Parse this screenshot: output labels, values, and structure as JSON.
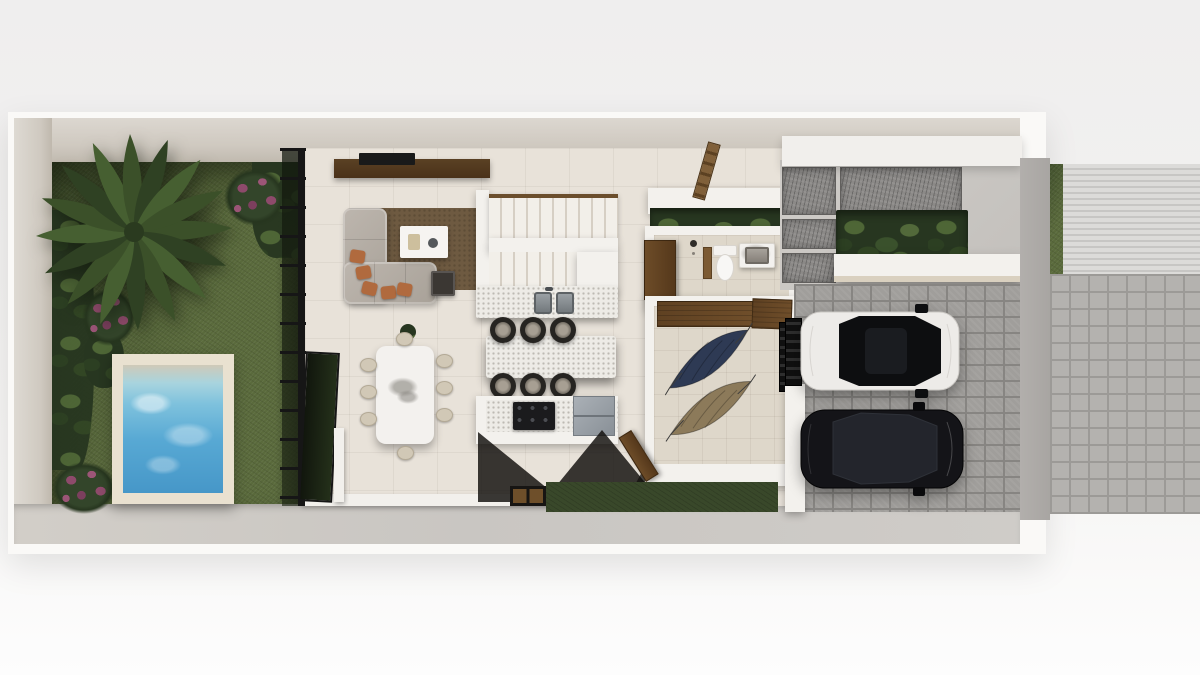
{
  "meta": {
    "title": "Townhouse ground-floor plan — top-down 3D render",
    "view": "top-down",
    "style": "architectural visualization, no text labels"
  },
  "palette": {
    "background_top": "#efeeee",
    "background_bottom": "#fdfdfd",
    "plot_rim": "#faf9f7",
    "wall_light": "#dcd7d0",
    "wall_dark": "#bfb8ad",
    "lawn": "#5a6a3c",
    "lawn_dark": "#42512d",
    "lawn_front": "#39482a",
    "flower": "#8e4a6b",
    "leaf": "#3a512c",
    "pool_frame": "#e9e1d0",
    "pool_water": "#4f9fd0",
    "floor": "#e8e2d9",
    "terrace": "#d6d1c8",
    "frame_black": "#161616",
    "wood": "#6d4c28",
    "wood_dark": "#55381b",
    "rug": "#6e5a41",
    "sofa": "#b3aca3",
    "cushion": "#b06a3e",
    "white_furniture": "#f3f1ed",
    "counter": "#edebe6",
    "stool": "#262421",
    "steel": "#99a0a7",
    "stone_slab": "#8b8987",
    "concrete": "#c9c6c2",
    "paver": "#a09e9b",
    "paver_gap": "#878582",
    "side_wall": "#a8a5a2",
    "sidewalk": "#b4b2af",
    "sidewalk_gap": "#9c9a97",
    "stripe_light": "#dcdbd9",
    "stripe_dark": "#c7c6c4",
    "hammock_navy": "#2e3a54",
    "hammock_tan": "#8c7a5a",
    "car_white": "#edebe8",
    "car_black": "#141418",
    "marble": "#f3f1ee"
  },
  "areas": {
    "garden": {
      "label": "Side garden",
      "objects": [
        "lawn",
        "palm-tree",
        "flowering-bushes",
        "tropical-shrubs"
      ],
      "bush_count": 3
    },
    "pool": {
      "label": "Plunge pool",
      "objects": [
        "stone-deck-frame",
        "water",
        "tanning-shelf"
      ]
    },
    "glass_wall": {
      "label": "Steel-framed glass wall",
      "objects": [
        "black-steel-frame",
        "glass-panels",
        "open-glass-door"
      ]
    },
    "living_room": {
      "label": "Living room",
      "objects": [
        "tv-console",
        "tv",
        "l-shaped-sofa",
        "accent-cushions",
        "coffee-table",
        "side-table",
        "area-rug",
        "potted-plant"
      ],
      "cushion_count": 5
    },
    "dining_room": {
      "label": "Dining room",
      "objects": [
        "marble-dining-table",
        "dining-chairs"
      ],
      "chair_count": 8
    },
    "kitchen": {
      "label": "Kitchen & stairs",
      "objects": [
        "u-shaped-staircase",
        "prep-counter",
        "double-sink",
        "breakfast-island",
        "bar-stools",
        "gas-stove",
        "refrigerator",
        "doormat"
      ],
      "stool_count": 6,
      "stair_flights": 2
    },
    "bathroom": {
      "label": "Bathroom",
      "objects": [
        "wood-door",
        "shower",
        "wood-partition",
        "toilet",
        "marble-vanity-sink"
      ]
    },
    "hammock_lounge": {
      "label": "Hammock lounge",
      "objects": [
        "wood-console",
        "wood-cabinet",
        "navy-hammock",
        "tan-hammock",
        "open-wood-door",
        "side-gate"
      ],
      "hammock_count": 2
    },
    "entry": {
      "label": "Entry court",
      "objects": [
        "stone-step-slabs",
        "tropical-planter",
        "floating-canopy",
        "top-canopy",
        "roof-ladder"
      ],
      "slab_count": 4
    },
    "carport": {
      "label": "Carport",
      "objects": [
        "paver-floor",
        "white-suv-black-roof",
        "black-sedan",
        "side-walkway",
        "entry-gate"
      ],
      "car_count": 2
    },
    "street_side": {
      "label": "Street frontage",
      "objects": [
        "gray-boundary-wall",
        "grass-curb",
        "textured-ramp-pad",
        "paver-sidewalk",
        "concrete-walk"
      ]
    }
  }
}
